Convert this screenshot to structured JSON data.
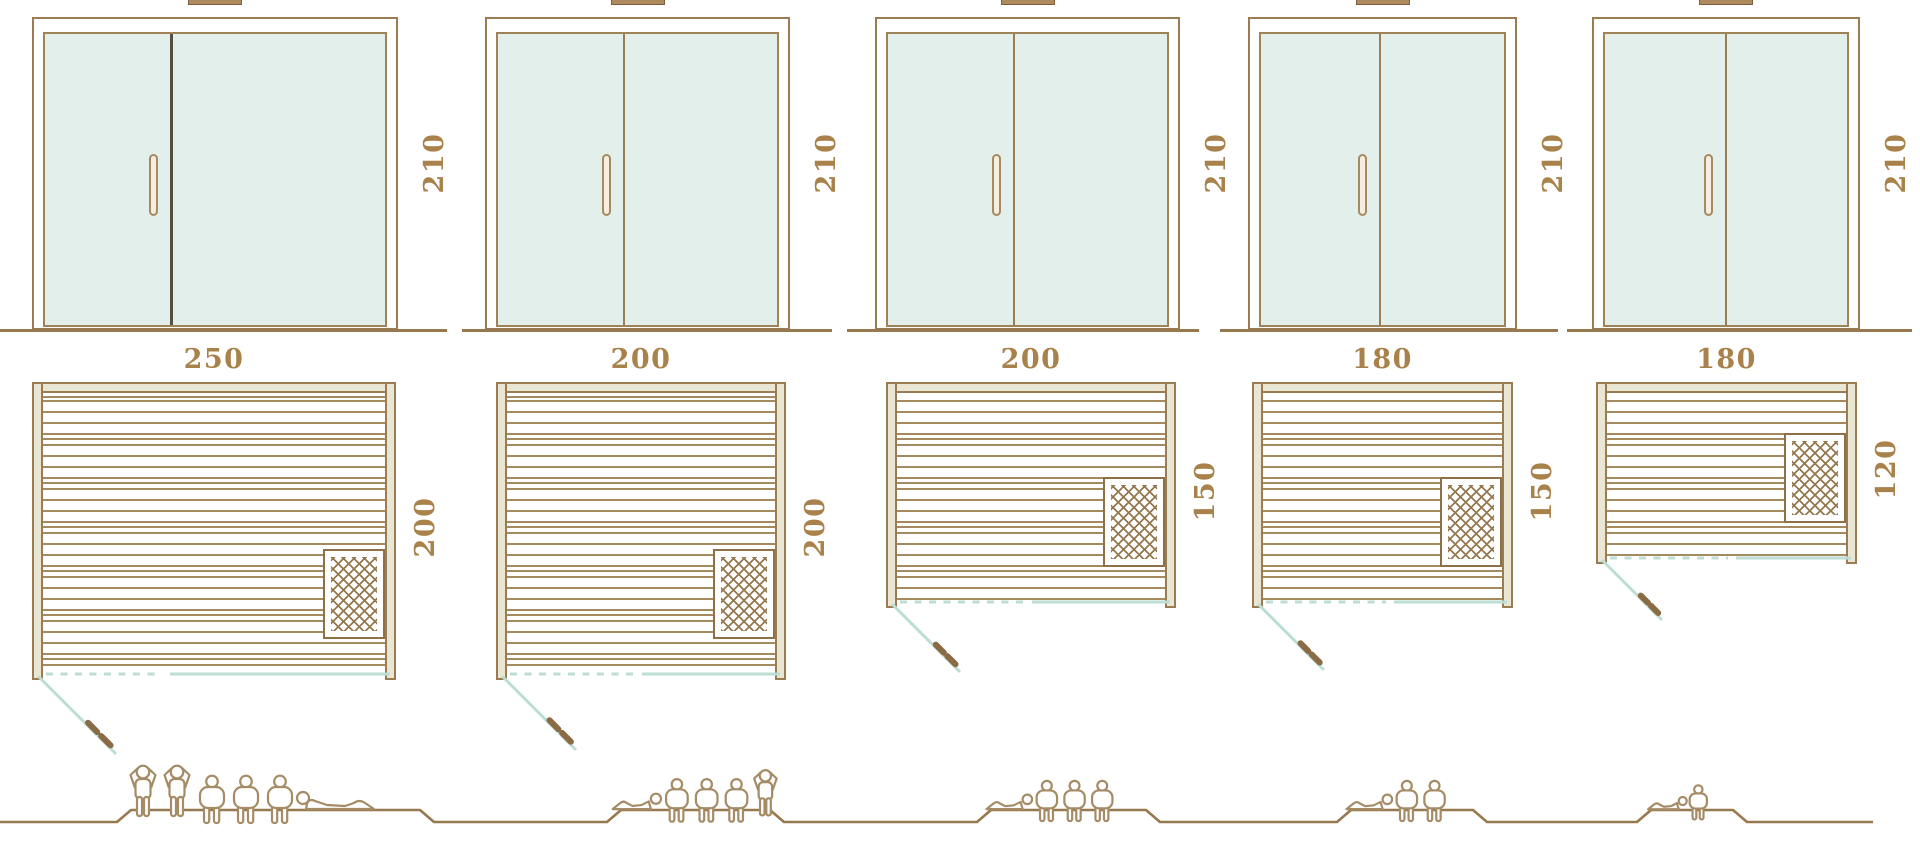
{
  "diagram": {
    "kind": "sauna-size-comparison",
    "columns": [
      {
        "id": "sauna-250x200",
        "width_cm": "250",
        "depth_cm": "200",
        "door_height_cm": "210",
        "capacity": 6,
        "capacity_figures": [
          "standing",
          "standing",
          "sitting",
          "sitting",
          "sitting",
          "lying"
        ]
      },
      {
        "id": "sauna-200x200",
        "width_cm": "200",
        "depth_cm": "200",
        "door_height_cm": "210",
        "capacity": 5,
        "capacity_figures": [
          "lying",
          "sitting",
          "sitting",
          "sitting",
          "standing"
        ]
      },
      {
        "id": "sauna-200x150",
        "width_cm": "200",
        "depth_cm": "150",
        "door_height_cm": "210",
        "capacity": 4,
        "capacity_figures": [
          "lying",
          "sitting",
          "sitting",
          "sitting"
        ]
      },
      {
        "id": "sauna-180x150",
        "width_cm": "180",
        "depth_cm": "150",
        "door_height_cm": "210",
        "capacity": 3,
        "capacity_figures": [
          "lying",
          "sitting",
          "sitting"
        ]
      },
      {
        "id": "sauna-180x120",
        "width_cm": "180",
        "depth_cm": "120",
        "door_height_cm": "210",
        "capacity": 2,
        "capacity_figures": [
          "lying",
          "sitting"
        ]
      }
    ],
    "colors": {
      "line_brown": "#9a7b52",
      "ground_brown": "#97794f",
      "label_brown": "#a9824b",
      "glass_fill": "#e3efea",
      "wall_fill": "#e9e6d3",
      "swing_teal": "#bcded5",
      "door1_divider_dark": "#565043",
      "divider_brown": "#9b7d55",
      "handle_fill": "#f6ecdf",
      "vent_fill": "#ae8a5e",
      "people_outline": "#a58c66",
      "background": "#ffffff"
    },
    "icons": {
      "heater": "heater-crosshatch-icon",
      "door_swing": "door-swing-icon",
      "person_standing": "person-standing-icon",
      "person_sitting": "person-sitting-icon",
      "person_lying": "person-lying-icon"
    }
  }
}
